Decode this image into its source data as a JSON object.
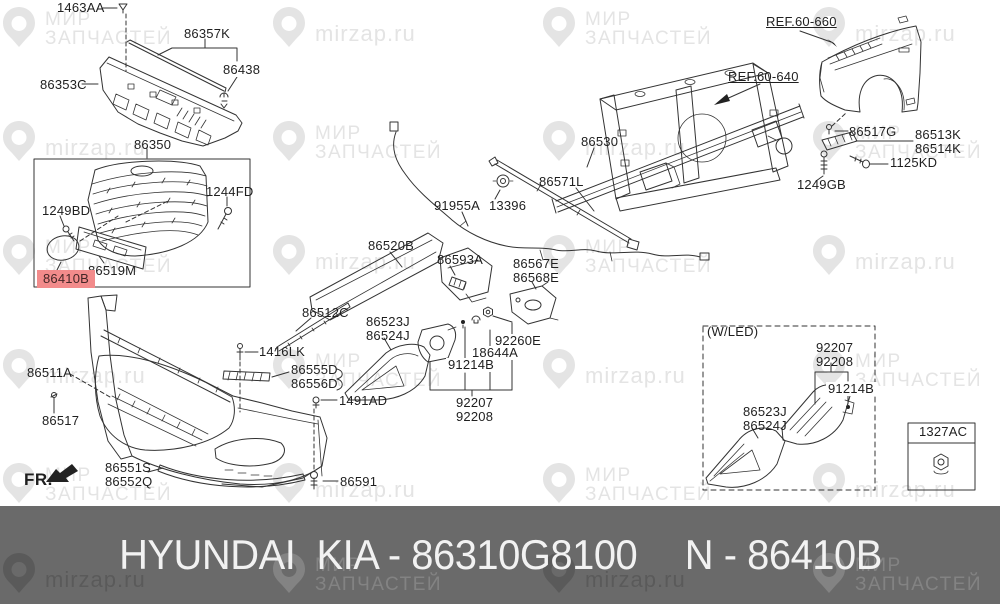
{
  "watermark": {
    "brand_line1": "МИР",
    "brand_line2": "ЗАПЧАСТЕЙ",
    "site": "mirzap.ru"
  },
  "colors": {
    "highlight_bg": "#f28b8b",
    "line": "#333333",
    "watermark_light": "#e4e4e4",
    "banner_bg": "#6a6a6a",
    "banner_fg": "#f2f2f2"
  },
  "diagram": {
    "highlighted_part": "86410B",
    "wled_box_title": "(W/LED)",
    "labels": [
      {
        "id": "1463AA",
        "lines": [
          "1463AA"
        ],
        "x": 57,
        "y": 1
      },
      {
        "id": "86357K",
        "lines": [
          "86357K"
        ],
        "x": 184,
        "y": 27
      },
      {
        "id": "86438",
        "lines": [
          "86438"
        ],
        "x": 221,
        "y": 63,
        "cls": "bgw"
      },
      {
        "id": "86353C",
        "lines": [
          "86353C"
        ],
        "x": 40,
        "y": 78
      },
      {
        "id": "86350",
        "lines": [
          "86350"
        ],
        "x": 134,
        "y": 138
      },
      {
        "id": "1244FD",
        "lines": [
          "1244FD"
        ],
        "x": 206,
        "y": 185
      },
      {
        "id": "1249BD",
        "lines": [
          "1249BD"
        ],
        "x": 42,
        "y": 204
      },
      {
        "id": "86519M",
        "lines": [
          "86519M"
        ],
        "x": 88,
        "y": 264
      },
      {
        "id": "86410B",
        "lines": [
          "86410B"
        ],
        "x": 37,
        "y": 270,
        "cls": "hl"
      },
      {
        "id": "86511A",
        "lines": [
          "86511A"
        ],
        "x": 27,
        "y": 366
      },
      {
        "id": "86517",
        "lines": [
          "86517"
        ],
        "x": 42,
        "y": 414
      },
      {
        "id": "86551S-86552Q",
        "lines": [
          "86551S",
          "86552Q"
        ],
        "x": 105,
        "y": 461
      },
      {
        "id": "FR",
        "lines": [
          "FR."
        ],
        "x": 24,
        "y": 473,
        "cls": "fr"
      },
      {
        "id": "86591",
        "lines": [
          "86591"
        ],
        "x": 340,
        "y": 475
      },
      {
        "id": "1491AD",
        "lines": [
          "1491AD"
        ],
        "x": 339,
        "y": 394
      },
      {
        "id": "86523J-86524J",
        "lines": [
          "86523J",
          "86524J"
        ],
        "x": 366,
        "y": 315
      },
      {
        "id": "86512C",
        "lines": [
          "86512C"
        ],
        "x": 302,
        "y": 306
      },
      {
        "id": "1416LK",
        "lines": [
          "1416LK"
        ],
        "x": 259,
        "y": 345
      },
      {
        "id": "86555D-86556D",
        "lines": [
          "86555D",
          "86556D"
        ],
        "x": 291,
        "y": 363
      },
      {
        "id": "91214B",
        "lines": [
          "91214B"
        ],
        "x": 446,
        "y": 358,
        "cls": "bgw"
      },
      {
        "id": "18644A",
        "lines": [
          "18644A"
        ],
        "x": 470,
        "y": 346,
        "cls": "bgw"
      },
      {
        "id": "92260E",
        "lines": [
          "92260E"
        ],
        "x": 493,
        "y": 334,
        "cls": "bgw"
      },
      {
        "id": "92207-92208",
        "lines": [
          "92207",
          "92208"
        ],
        "x": 456,
        "y": 396
      },
      {
        "id": "86593A",
        "lines": [
          "86593A"
        ],
        "x": 437,
        "y": 253
      },
      {
        "id": "86520B",
        "lines": [
          "86520B"
        ],
        "x": 368,
        "y": 239
      },
      {
        "id": "91955A",
        "lines": [
          "91955A"
        ],
        "x": 434,
        "y": 199
      },
      {
        "id": "13396",
        "lines": [
          "13396"
        ],
        "x": 489,
        "y": 199
      },
      {
        "id": "86571L",
        "lines": [
          "86571L"
        ],
        "x": 539,
        "y": 175
      },
      {
        "id": "86530",
        "lines": [
          "86530"
        ],
        "x": 581,
        "y": 135
      },
      {
        "id": "86567E-86568E",
        "lines": [
          "86567E",
          "86568E"
        ],
        "x": 513,
        "y": 257
      },
      {
        "id": "REF.60-640",
        "lines": [
          "REF.60-640"
        ],
        "x": 728,
        "y": 70,
        "cls": "ref"
      },
      {
        "id": "REF.60-660",
        "lines": [
          "REF.60-660"
        ],
        "x": 766,
        "y": 15,
        "cls": "ref"
      },
      {
        "id": "86517G",
        "lines": [
          "86517G"
        ],
        "x": 849,
        "y": 125
      },
      {
        "id": "86513K-86514K",
        "lines": [
          "86513K",
          "86514K"
        ],
        "x": 915,
        "y": 128
      },
      {
        "id": "1125KD",
        "lines": [
          "1125KD"
        ],
        "x": 890,
        "y": 156
      },
      {
        "id": "1249GB",
        "lines": [
          "1249GB"
        ],
        "x": 797,
        "y": 178
      },
      {
        "id": "WLED",
        "lines": [
          "(W/LED)"
        ],
        "x": 707,
        "y": 325
      },
      {
        "id": "92207-92208-led",
        "lines": [
          "92207",
          "92208"
        ],
        "x": 816,
        "y": 341
      },
      {
        "id": "91214B-led",
        "lines": [
          "91214B"
        ],
        "x": 826,
        "y": 382,
        "cls": "bgw"
      },
      {
        "id": "86523J-86524J-led",
        "lines": [
          "86523J",
          "86524J"
        ],
        "x": 743,
        "y": 405
      },
      {
        "id": "1327AC",
        "lines": [
          "1327AC"
        ],
        "x": 919,
        "y": 425
      }
    ]
  },
  "banner": {
    "caption_left": "HYUNDAI  KIA - 86310G8100",
    "caption_right": "N - 86410B"
  }
}
